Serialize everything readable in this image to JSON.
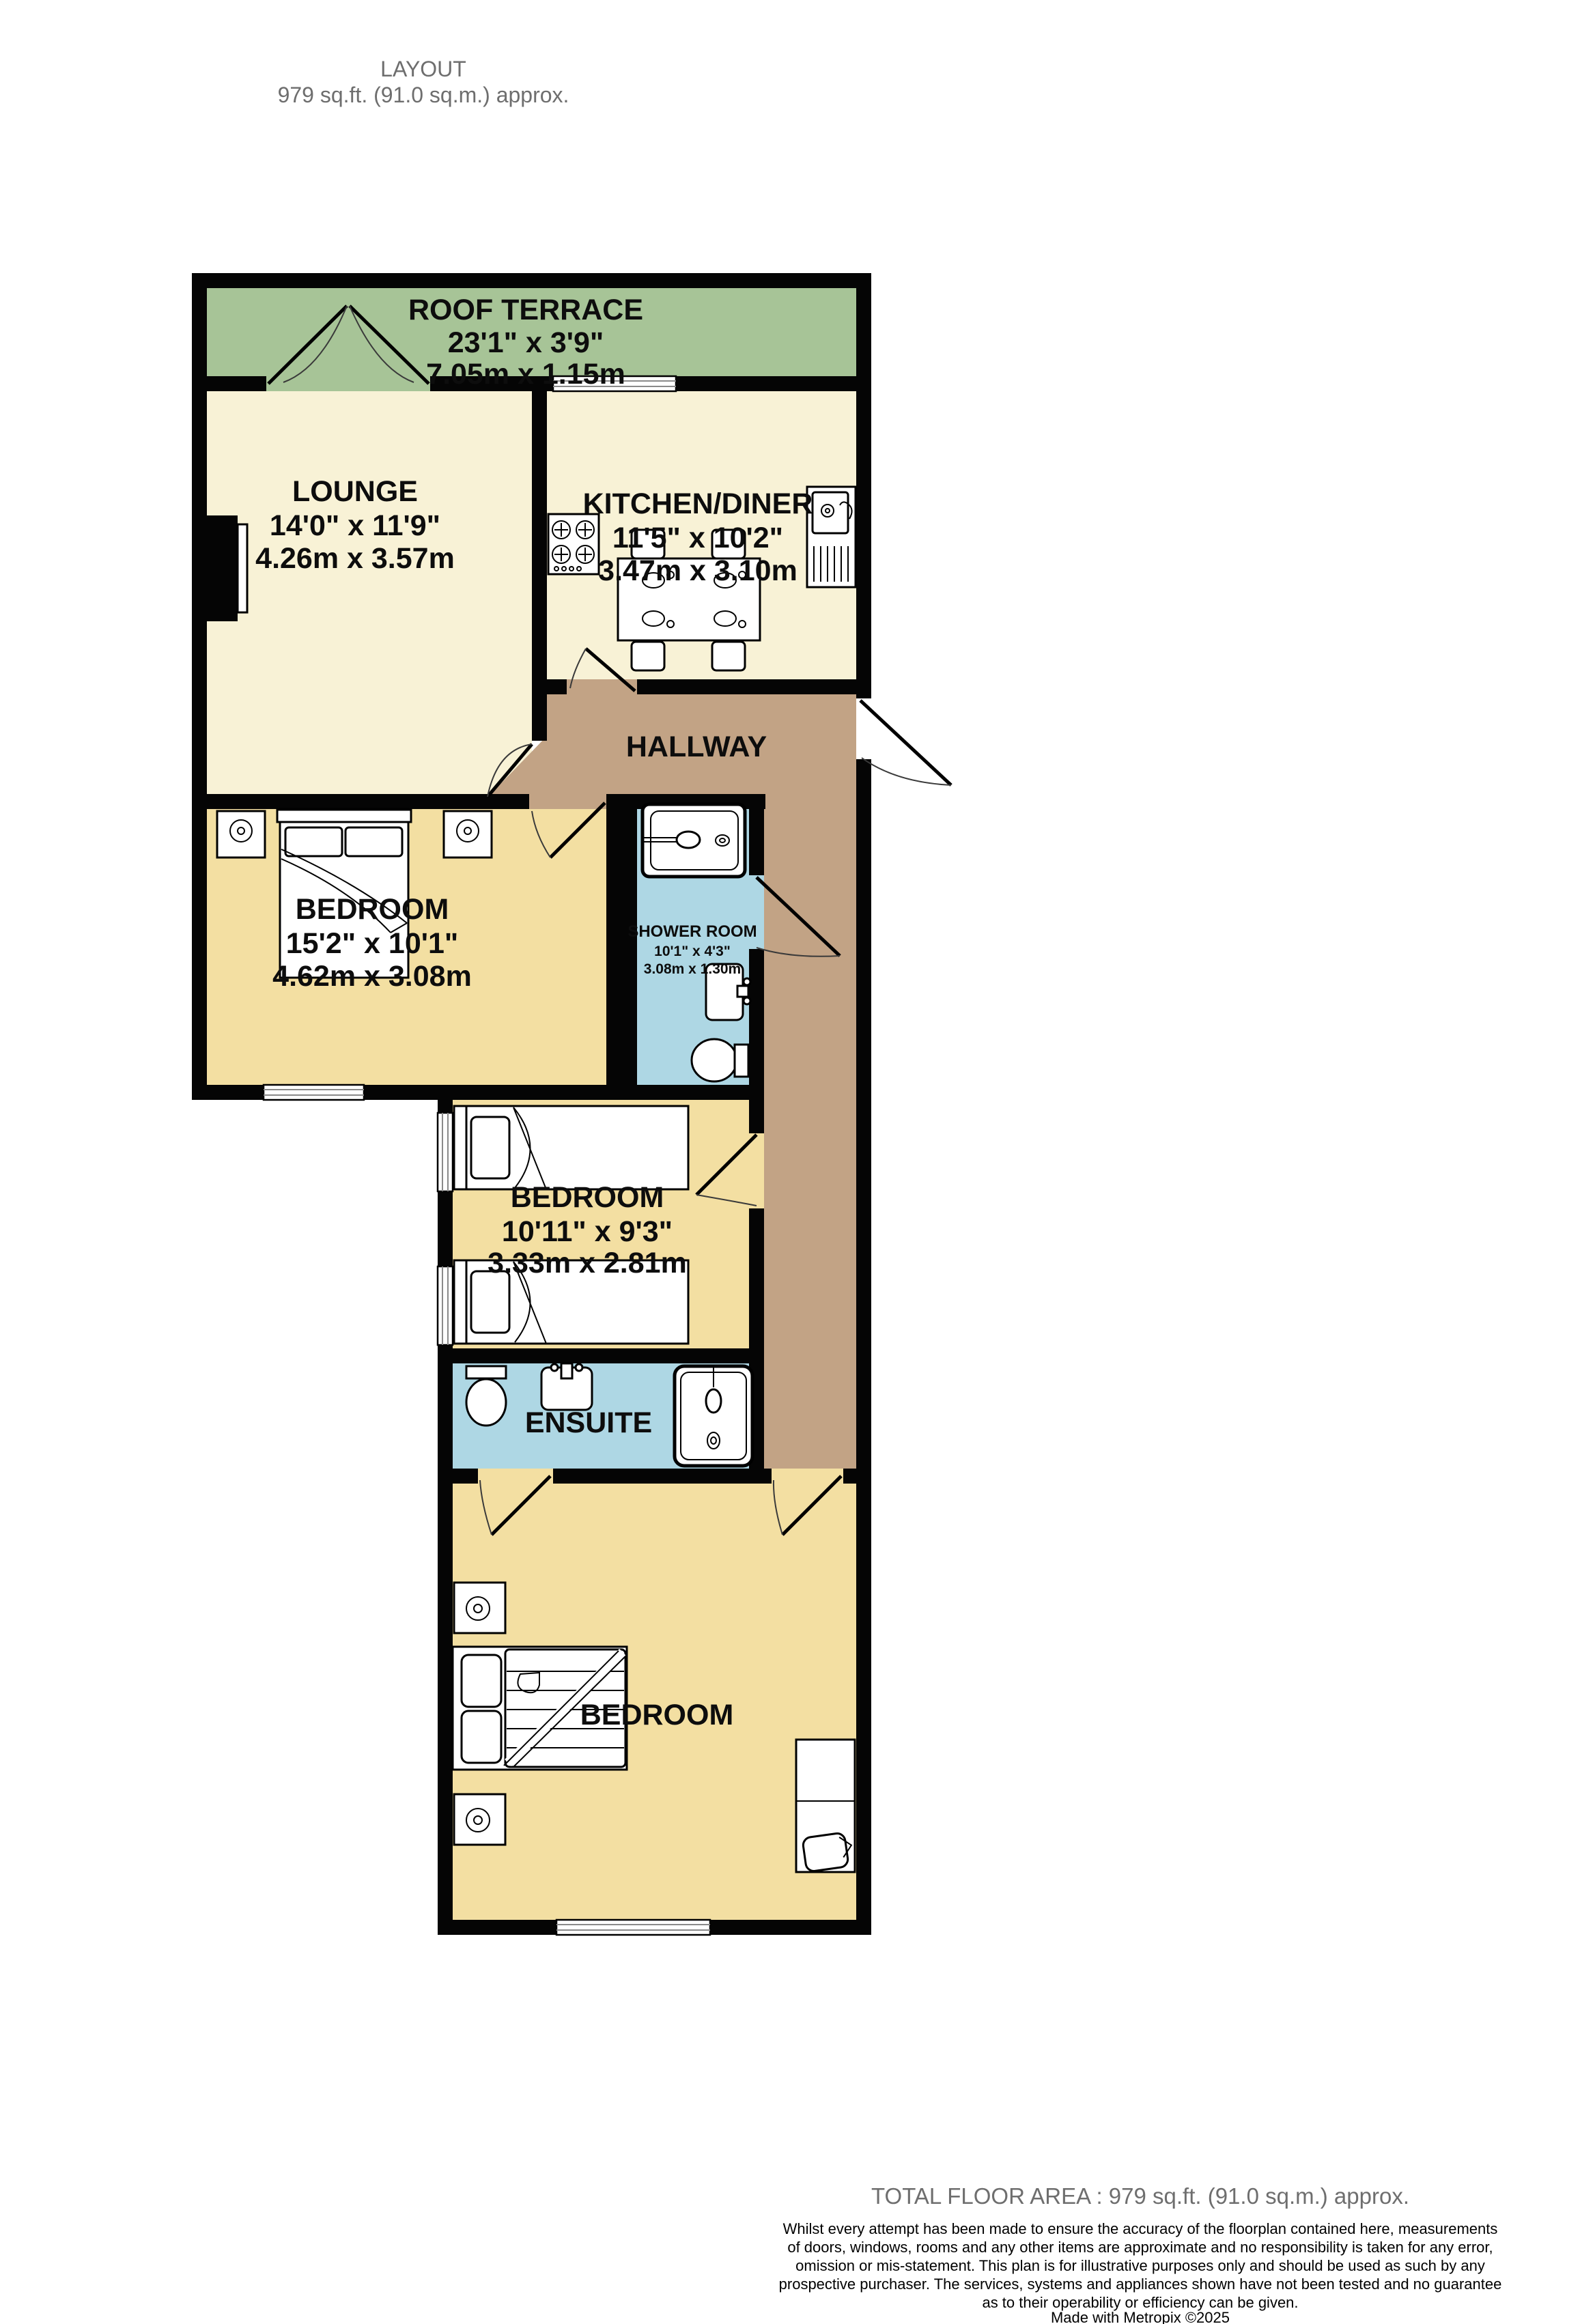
{
  "header": {
    "line1": "LAYOUT",
    "line2": "979 sq.ft. (91.0 sq.m.) approx."
  },
  "rooms": {
    "roof_terrace": {
      "name": "ROOF TERRACE",
      "imperial": "23'1\"  x 3'9\"",
      "metric": "7.05m  x 1.15m"
    },
    "lounge": {
      "name": "LOUNGE",
      "imperial": "14'0\"  x 11'9\"",
      "metric": "4.26m  x 3.57m"
    },
    "kitchen": {
      "name": "KITCHEN/DINER",
      "imperial": "11'5\"  x 10'2\"",
      "metric": "3.47m  x 3.10m"
    },
    "hallway": {
      "name": "HALLWAY"
    },
    "bedroom1": {
      "name": "BEDROOM",
      "imperial": "15'2\"  x 10'1\"",
      "metric": "4.62m  x 3.08m"
    },
    "shower_room": {
      "name": "SHOWER ROOM",
      "imperial": "10'1\"  x 4'3\"",
      "metric": "3.08m  x 1.30m"
    },
    "bedroom2": {
      "name": "BEDROOM",
      "imperial": "10'11\"  x 9'3\"",
      "metric": "3.33m  x 2.81m"
    },
    "ensuite": {
      "name": "ENSUITE"
    },
    "bedroom3": {
      "name": "BEDROOM"
    }
  },
  "footer": {
    "total": "TOTAL FLOOR AREA : 979 sq.ft. (91.0 sq.m.) approx.",
    "disclaimer": [
      "Whilst every attempt has been made to ensure the accuracy of the floorplan contained here, measurements",
      "of doors, windows, rooms and any other items are approximate and no responsibility is taken for any error,",
      "omission or mis-statement. This plan is for illustrative purposes only and should be used as such by any",
      "prospective purchaser. The services, systems and appliances shown have not been tested and no guarantee",
      "as to their operability or efficiency can be given."
    ],
    "credit": "Made with Metropix ©2025"
  },
  "colors": {
    "wall": "#050505",
    "terrace": "#a7c497",
    "living": "#f8f2d6",
    "bedroom": "#f3dfa2",
    "bathroom": "#aed7e4",
    "hallway": "#c2a385",
    "muted_text": "#6e6e6e"
  }
}
